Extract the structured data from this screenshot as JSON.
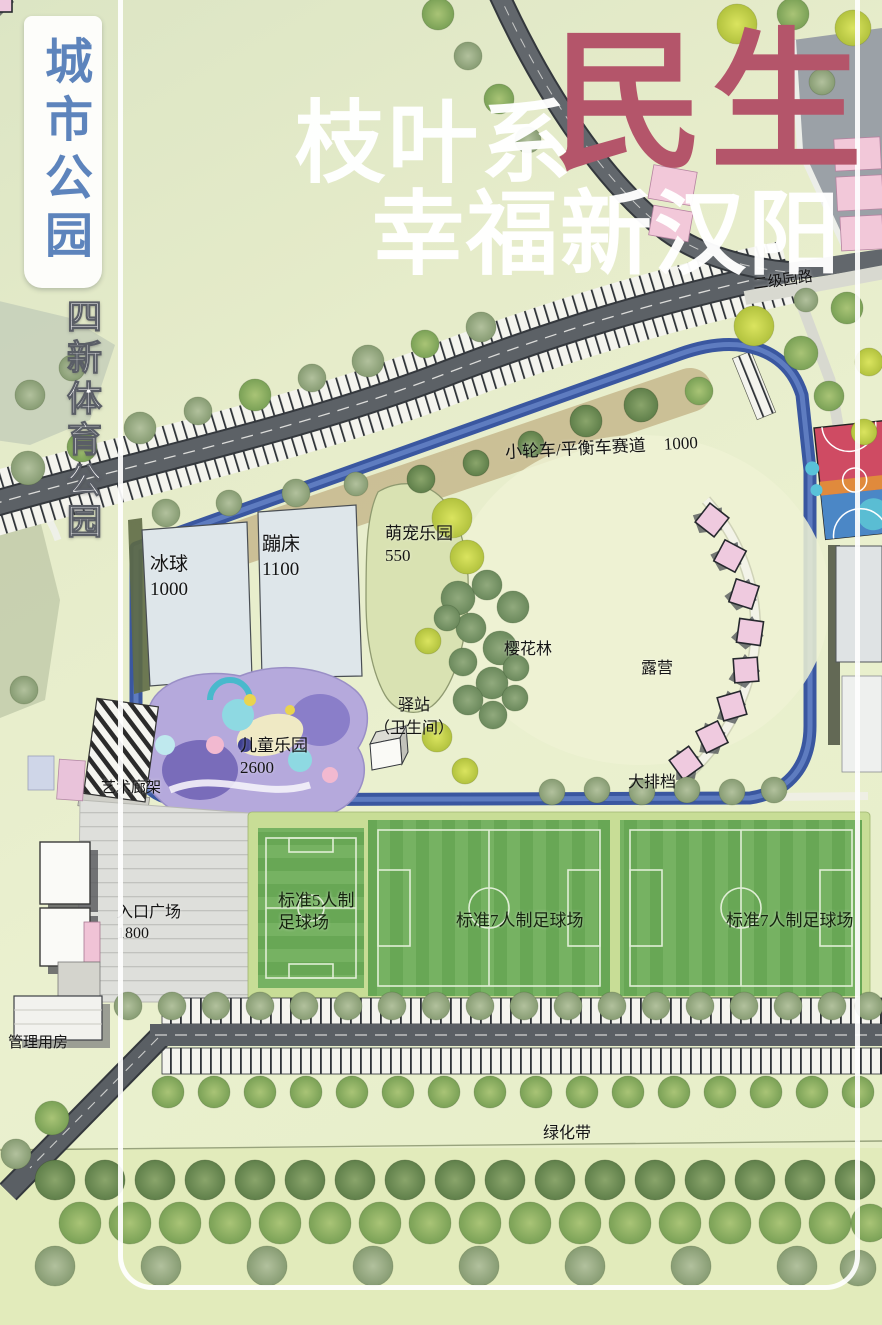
{
  "poster": {
    "side_title": "城市公园",
    "side_subtitle": "四新体育公园",
    "headline_white": "枝叶系",
    "headline_accent": "民生",
    "headline_line2": "幸福新汉阳"
  },
  "map_labels": {
    "secondary_road": "二级园路",
    "bike_track": "小轮车/平衡车赛道",
    "bike_track_area": "1000",
    "ice_hockey": "冰球",
    "ice_hockey_area": "1000",
    "trampoline": "蹦床",
    "trampoline_area": "1100",
    "pet_park": "萌宠乐园",
    "pet_park_area": "550",
    "cherry_forest": "樱花林",
    "camping": "露营",
    "station": "驿站",
    "station_note": "（卫生间）",
    "kids_park": "儿童乐园",
    "kids_park_area": "2600",
    "art_pergola": "艺术廊架",
    "food_stalls": "大排档",
    "entrance_plaza": "入口广场",
    "entrance_plaza_area": "1800",
    "soccer5_line1": "标准5人制",
    "soccer5_line2": "足球场",
    "soccer7_mid": "标准7人制足球场",
    "soccer7_right": "标准7人制足球场",
    "management": "管理用房",
    "green_belt": "绿化带"
  },
  "colors": {
    "accent_red": "#b4556a",
    "title_blue": "#5d84bc",
    "track_blue": "#3d5ea6",
    "road_gray": "#5a5f64",
    "field_green": "#6fae58",
    "tent_pink": "#efcadf",
    "playground_purple": "#b5a9dc",
    "background_green": "#e7edc9"
  }
}
